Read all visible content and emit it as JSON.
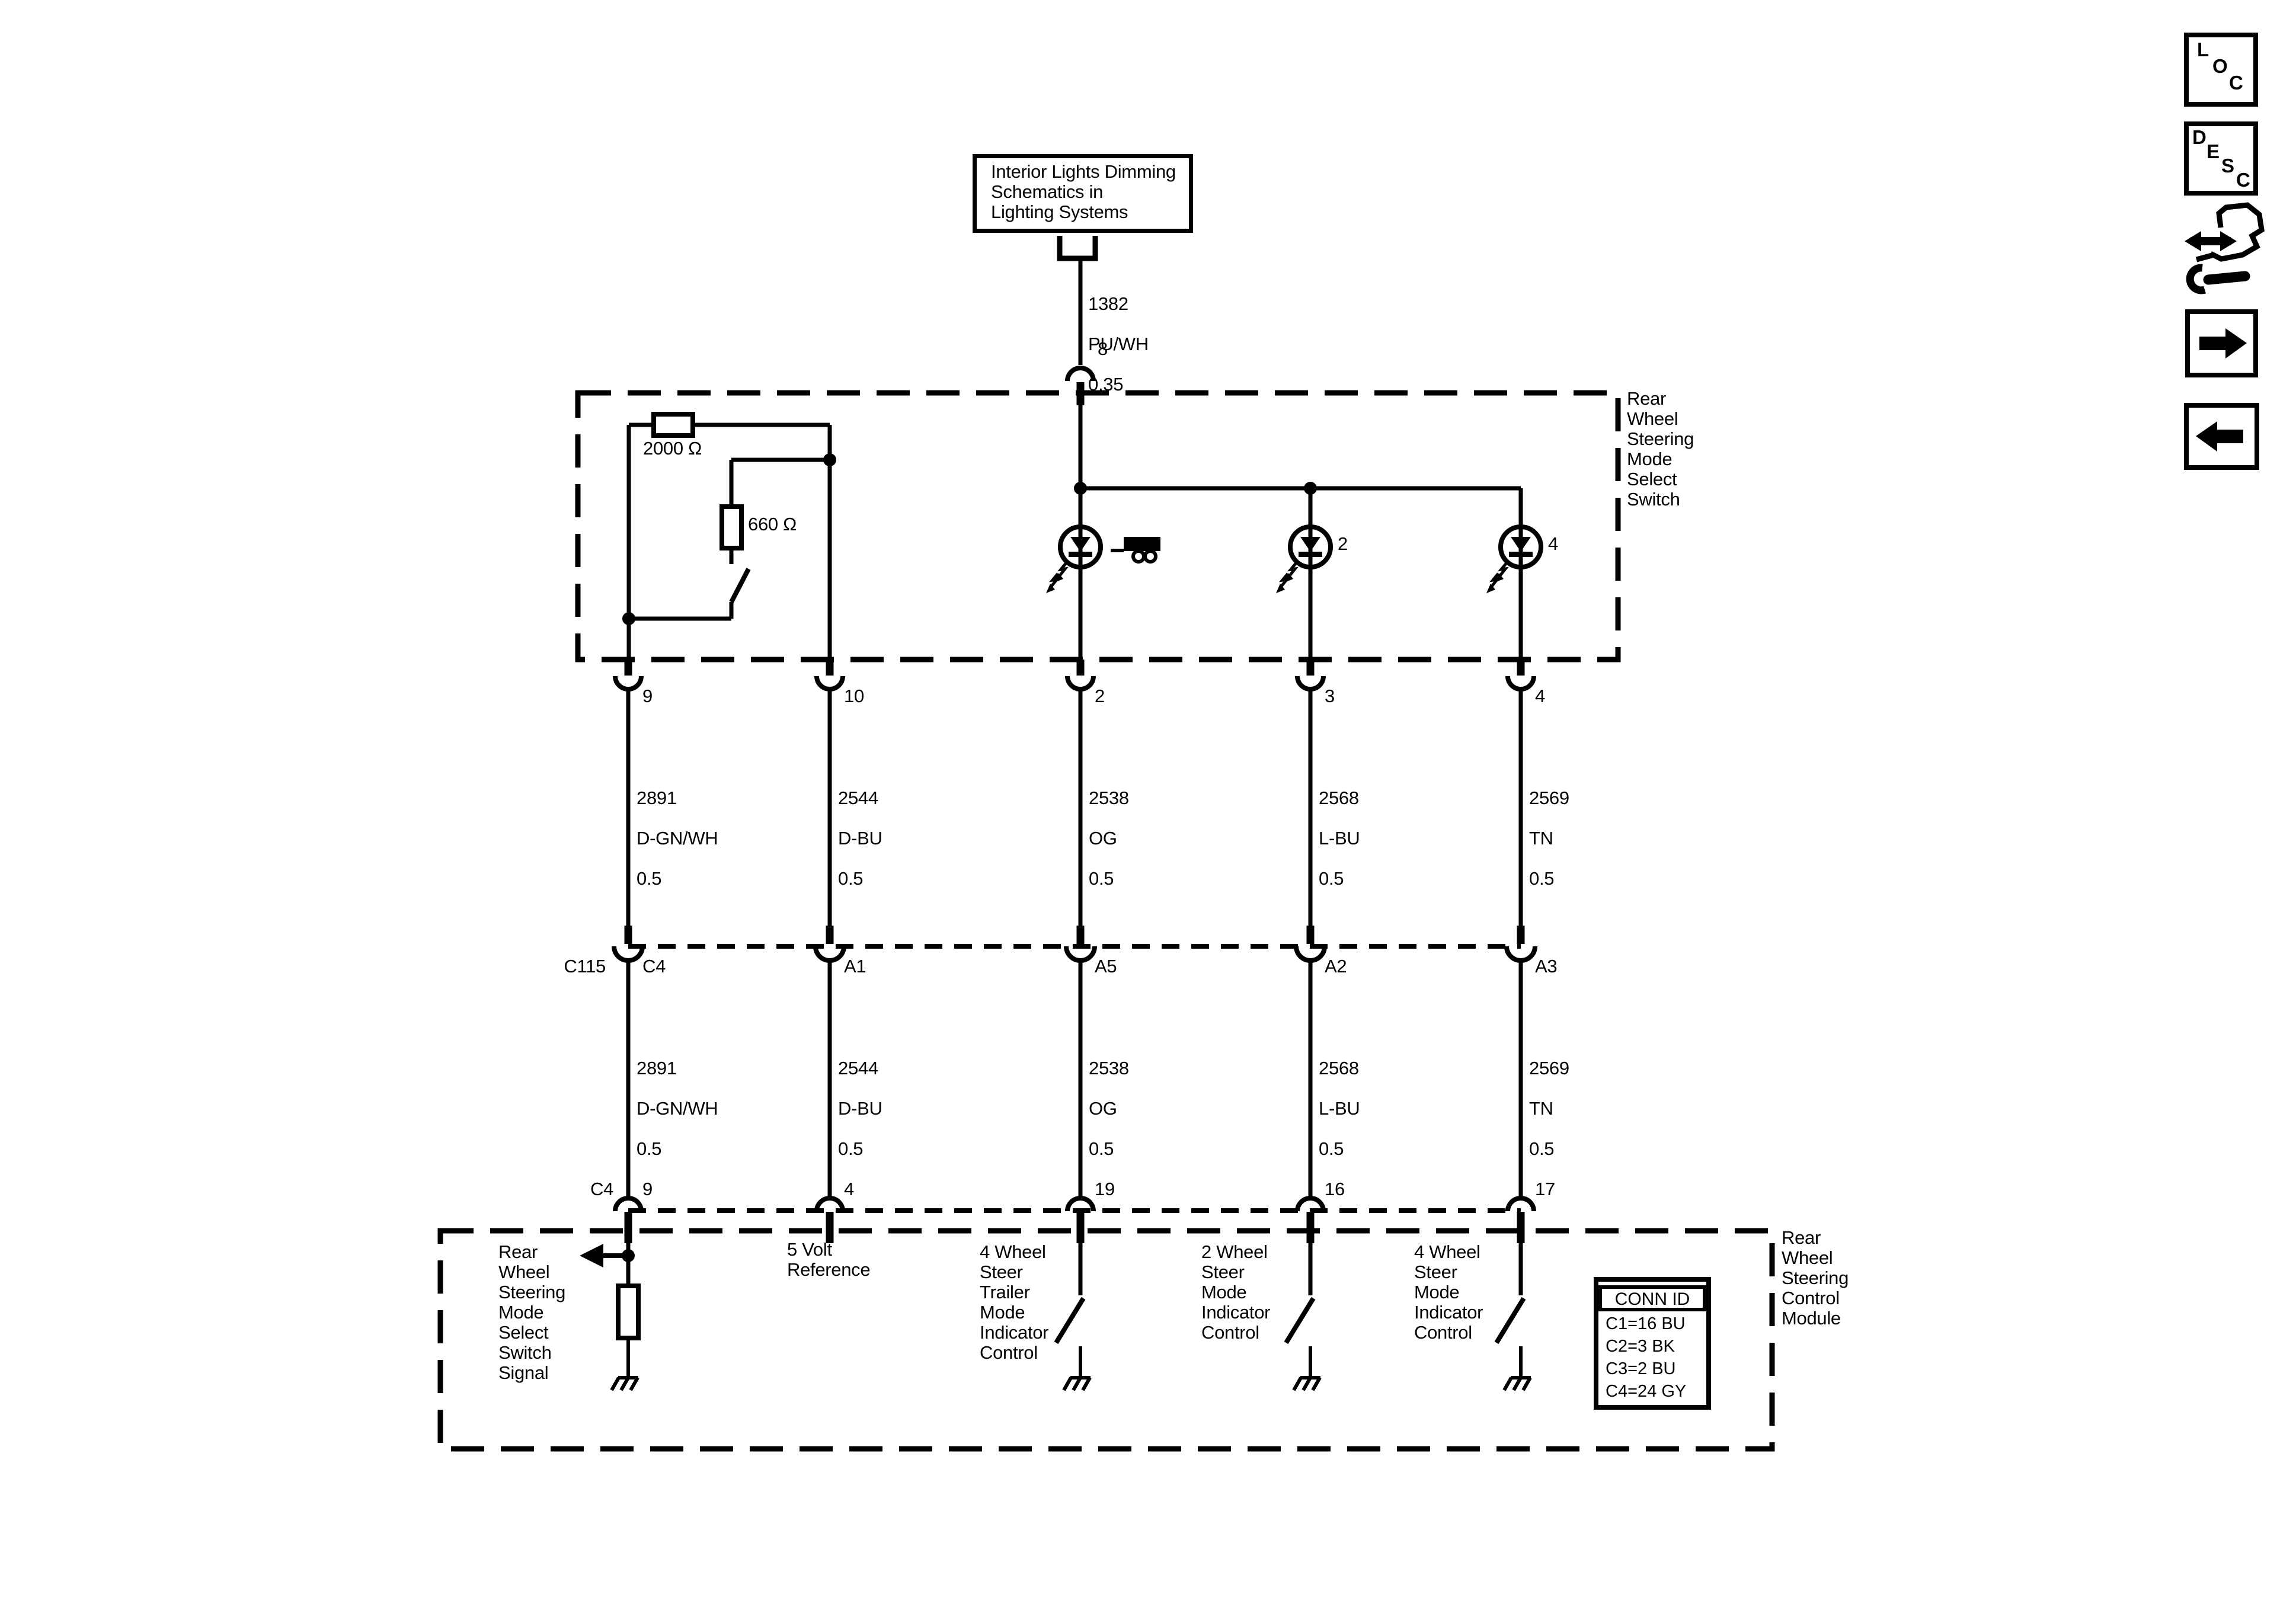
{
  "source_box": {
    "text": "Interior Lights Dimming\nSchematics in\nLighting Systems"
  },
  "feed_wire": {
    "circuit": "1382",
    "color": "PU/WH",
    "gauge": "0.35",
    "pin": "8"
  },
  "switch_box": {
    "label": "Rear\nWheel\nSteering\nMode\nSelect\nSwitch",
    "resistor_top": "2000 Ω",
    "resistor_branch": "660 Ω",
    "led_2_pin": "2",
    "led_4_pin": "4"
  },
  "pins_top": [
    "9",
    "10",
    "2",
    "3",
    "4"
  ],
  "wires": [
    {
      "circuit": "2891",
      "color": "D-GN/WH",
      "gauge": "0.5"
    },
    {
      "circuit": "2544",
      "color": "D-BU",
      "gauge": "0.5"
    },
    {
      "circuit": "2538",
      "color": "OG",
      "gauge": "0.5"
    },
    {
      "circuit": "2568",
      "color": "L-BU",
      "gauge": "0.5"
    },
    {
      "circuit": "2569",
      "color": "TN",
      "gauge": "0.5"
    }
  ],
  "connector": {
    "name": "C115",
    "pins": [
      "C4",
      "A1",
      "A5",
      "A2",
      "A3"
    ]
  },
  "module_pins": {
    "connector": "C4",
    "pins": [
      "9",
      "4",
      "19",
      "16",
      "17"
    ]
  },
  "module": {
    "label": "Rear\nWheel\nSteering\nControl\nModule",
    "functions": [
      "Rear\nWheel\nSteering\nMode\nSelect\nSwitch\nSignal",
      "5 Volt\nReference",
      "4 Wheel\nSteer\nTrailer\nMode\nIndicator\nControl",
      "2 Wheel\nSteer\nMode\nIndicator\nControl",
      "4 Wheel\nSteer\nMode\nIndicator\nControl"
    ],
    "conn_id": {
      "header": "CONN ID",
      "rows": [
        "C1=16 BU",
        "C2=3 BK",
        "C3=2 BU",
        "C4=24 GY"
      ]
    }
  },
  "toolbar": {
    "loc": [
      "L",
      "O",
      "C"
    ],
    "desc": [
      "D",
      "E",
      "S",
      "C"
    ]
  },
  "colors": {
    "ink": "#000000",
    "paper": "#ffffff"
  }
}
